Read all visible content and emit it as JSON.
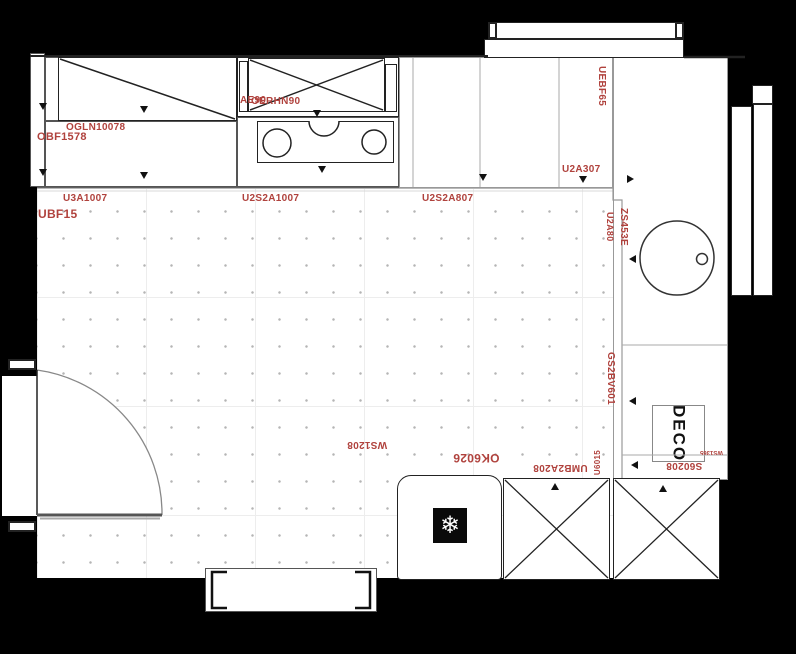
{
  "plan_title": "kitchen-floor-plan",
  "labels": {
    "obf1578": "OBF1578",
    "ogln10078": "OGLN10078",
    "hood_a": "AE90",
    "hood_b": "OERHN90",
    "u3a1007": "U3A1007",
    "ubf15": "UBF15",
    "u2s2a1007": "U2S2A1007",
    "u2s2a807": "U2S2A807",
    "u2a307": "U2A307",
    "uebf65": "UEBF65",
    "u2a80": "U2A80",
    "zs453e": "ZS453E",
    "gs2bv601": "GS2BV601",
    "ws1208": "WS1208",
    "ok6026": "OK6026",
    "umb2a208": "UMB2A208",
    "u6015": "U6015",
    "s60208": "S60208",
    "ws1365": "WS1365",
    "deco": "DECO"
  },
  "icons": {
    "freezer": "❄"
  },
  "colors": {
    "background": "#000000",
    "label_red": "#b0423d",
    "line_dark": "#222222",
    "line_light": "#999999"
  }
}
